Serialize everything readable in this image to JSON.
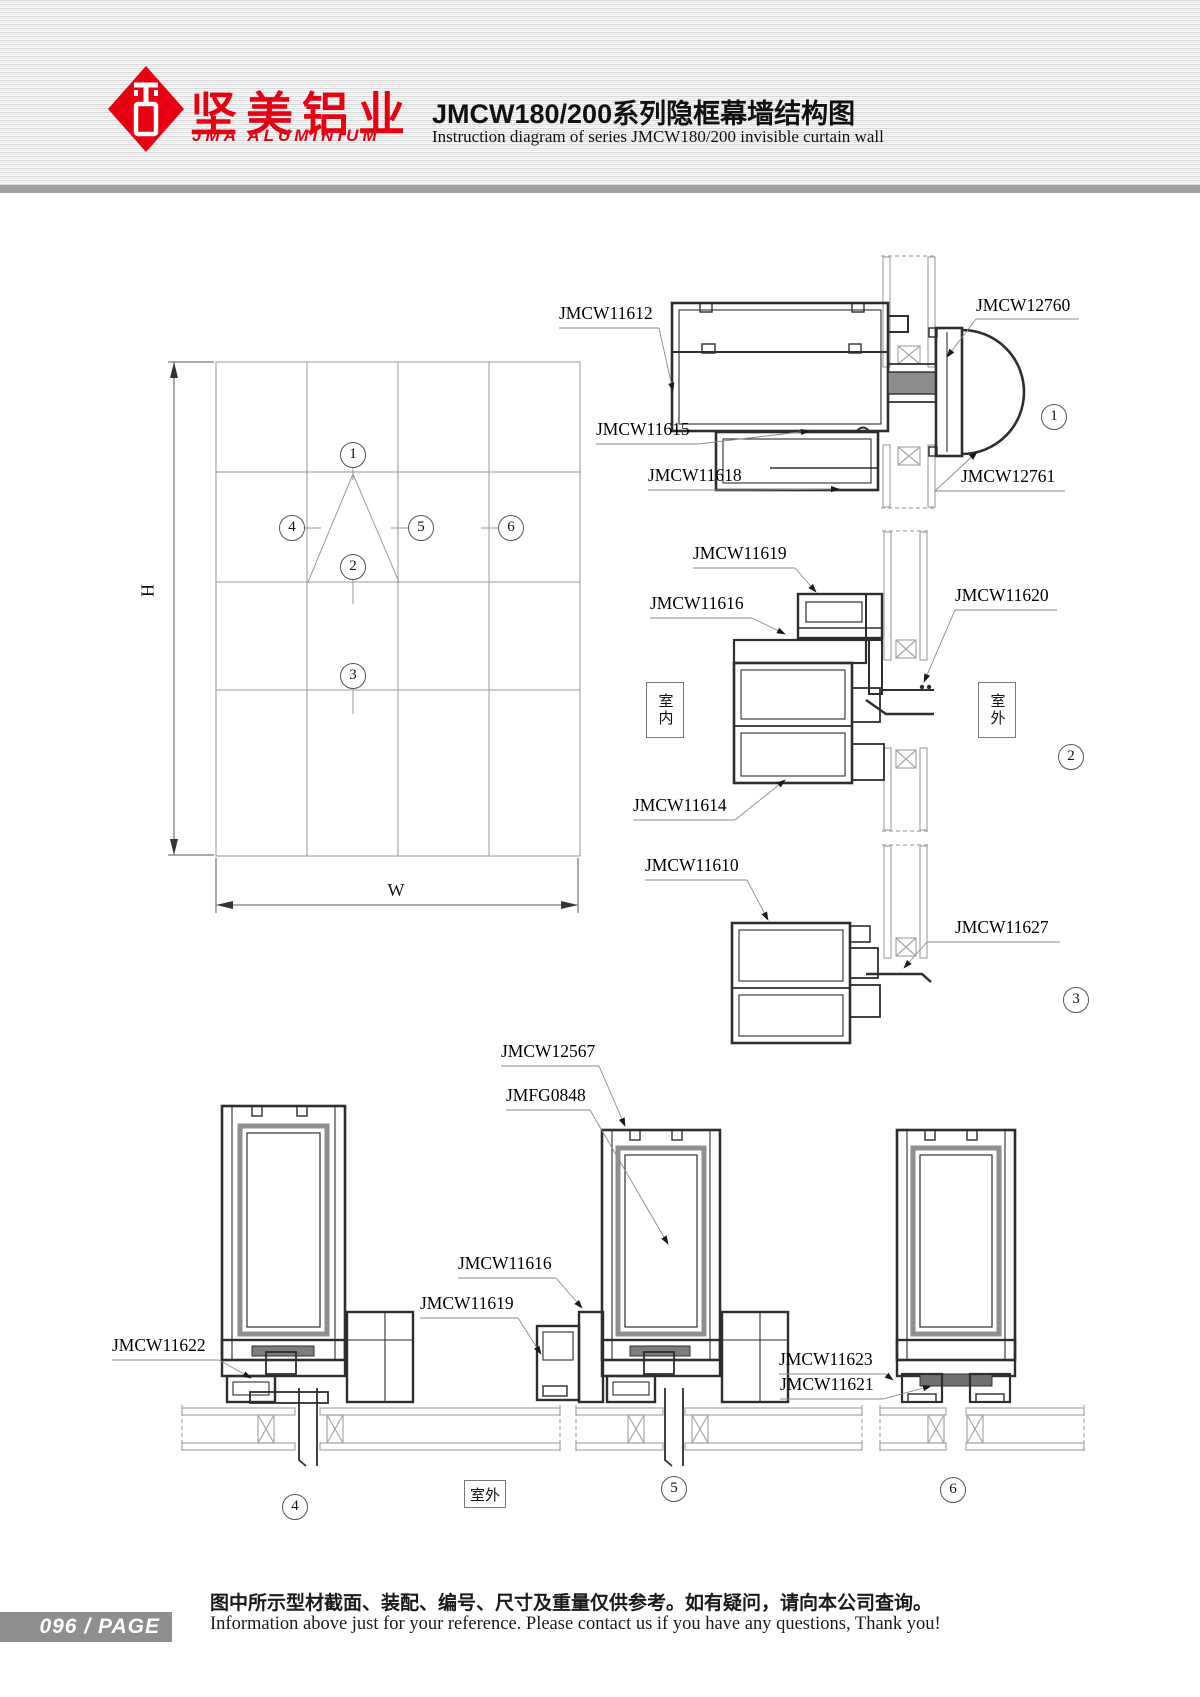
{
  "header": {
    "logo_cn": "坚美铝业",
    "logo_en": "JMA ALUMINIUM",
    "title": "JMCW180/200系列隐框幕墙结构图",
    "subtitle": "Instruction diagram of series JMCW180/200 invisible curtain wall"
  },
  "elevation": {
    "h_label": "H",
    "w_label": "W"
  },
  "room_labels": {
    "indoor": "室内",
    "outdoor": "室外",
    "outdoor_bottom": "室外"
  },
  "part_labels": [
    {
      "text": "JMCW11612",
      "x": 559,
      "y": 305
    },
    {
      "text": "JMCW12760",
      "x": 976,
      "y": 297
    },
    {
      "text": "JMCW11615",
      "x": 596,
      "y": 421
    },
    {
      "text": "JMCW11618",
      "x": 648,
      "y": 467
    },
    {
      "text": "JMCW12761",
      "x": 961,
      "y": 468
    },
    {
      "text": "JMCW11619",
      "x": 693,
      "y": 545
    },
    {
      "text": "JMCW11616",
      "x": 650,
      "y": 595
    },
    {
      "text": "JMCW11620",
      "x": 955,
      "y": 587
    },
    {
      "text": "JMCW11614",
      "x": 633,
      "y": 797
    },
    {
      "text": "JMCW11610",
      "x": 645,
      "y": 857
    },
    {
      "text": "JMCW11627",
      "x": 955,
      "y": 919
    },
    {
      "text": "JMCW12567",
      "x": 501,
      "y": 1043
    },
    {
      "text": "JMFG0848",
      "x": 506,
      "y": 1087
    },
    {
      "text": "JMCW11616",
      "x": 458,
      "y": 1255
    },
    {
      "text": "JMCW11619",
      "x": 420,
      "y": 1295
    },
    {
      "text": "JMCW11622",
      "x": 112,
      "y": 1337
    },
    {
      "text": "JMCW11623",
      "x": 779,
      "y": 1351
    },
    {
      "text": "JMCW11621",
      "x": 780,
      "y": 1376
    }
  ],
  "balloons": [
    {
      "n": "1",
      "x": 353,
      "y": 455
    },
    {
      "n": "2",
      "x": 353,
      "y": 567
    },
    {
      "n": "3",
      "x": 353,
      "y": 676
    },
    {
      "n": "4",
      "x": 292,
      "y": 528
    },
    {
      "n": "5",
      "x": 421,
      "y": 528
    },
    {
      "n": "6",
      "x": 511,
      "y": 528
    },
    {
      "n": "1",
      "x": 1054,
      "y": 417
    },
    {
      "n": "2",
      "x": 1071,
      "y": 757
    },
    {
      "n": "3",
      "x": 1076,
      "y": 1000
    },
    {
      "n": "4",
      "x": 295,
      "y": 1507
    },
    {
      "n": "5",
      "x": 674,
      "y": 1489
    },
    {
      "n": "6",
      "x": 953,
      "y": 1490
    }
  ],
  "footer": {
    "page_number": "096",
    "separator": "/",
    "page_word": "PAGE",
    "note_cn": "图中所示型材截面、装配、编号、尺寸及重量仅供参考。如有疑问，请向本公司查询。",
    "note_en": "Information above just for your reference. Please contact us if you have any questions, Thank you!"
  }
}
